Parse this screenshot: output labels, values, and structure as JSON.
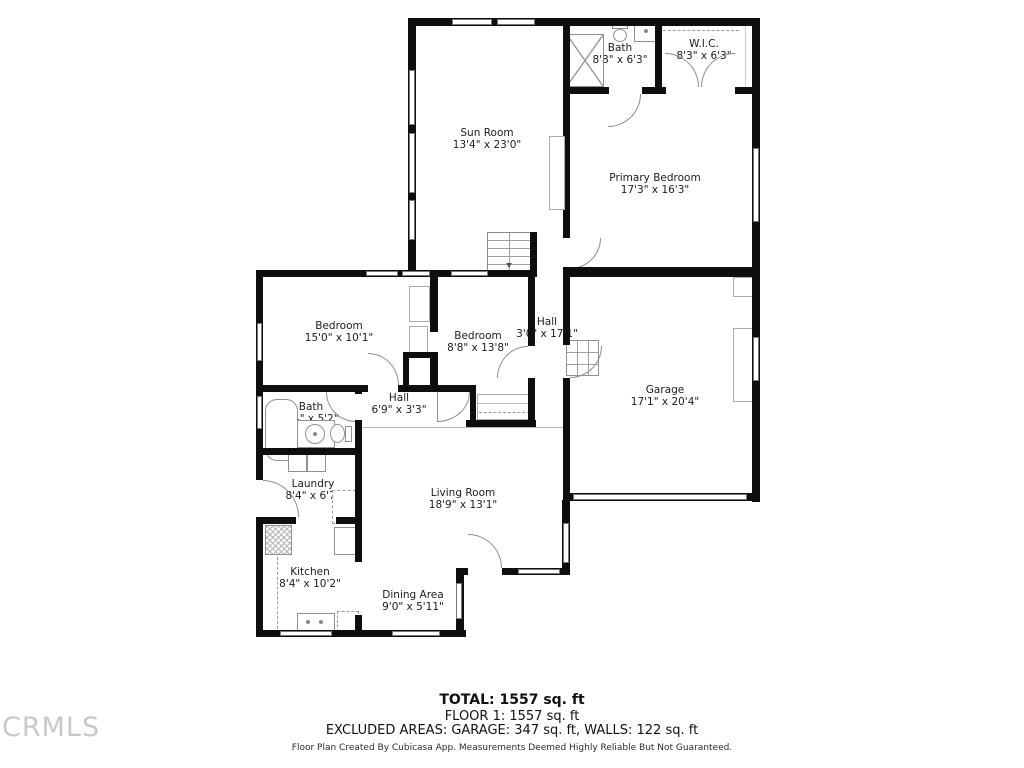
{
  "rooms": [
    {
      "id": "sun-room",
      "name": "Sun Room",
      "dims": "13'4\" x 23'0\""
    },
    {
      "id": "bath-upper",
      "name": "Bath",
      "dims": "8'8\" x 6'3\""
    },
    {
      "id": "wic",
      "name": "W.I.C.",
      "dims": "8'3\" x 6'3\""
    },
    {
      "id": "primary-bedroom",
      "name": "Primary Bedroom",
      "dims": "17'3\" x 16'3\""
    },
    {
      "id": "bedroom-left",
      "name": "Bedroom",
      "dims": "15'0\" x 10'1\""
    },
    {
      "id": "bedroom-middle",
      "name": "Bedroom",
      "dims": "8'8\" x 13'8\""
    },
    {
      "id": "hall-vertical",
      "name": "Hall",
      "dims": "3'0\" x 17'1\""
    },
    {
      "id": "garage",
      "name": "Garage",
      "dims": "17'1\" x 20'4\""
    },
    {
      "id": "bath-lower",
      "name": "Bath",
      "dims": "8'4\" x 5'2\""
    },
    {
      "id": "hall-small",
      "name": "Hall",
      "dims": "6'9\" x 3'3\""
    },
    {
      "id": "laundry",
      "name": "Laundry",
      "dims": "8'4\" x 6'7\""
    },
    {
      "id": "kitchen",
      "name": "Kitchen",
      "dims": "8'4\" x 10'2\""
    },
    {
      "id": "living-room",
      "name": "Living Room",
      "dims": "18'9\" x 13'1\""
    },
    {
      "id": "dining-area",
      "name": "Dining Area",
      "dims": "9'0\" x 5'11\""
    }
  ],
  "footer": {
    "total": "TOTAL: 1557 sq. ft",
    "floor": "FLOOR 1: 1557 sq. ft",
    "excluded": "EXCLUDED AREAS: GARAGE: 347 sq. ft, WALLS: 122 sq. ft",
    "disclaimer": "Floor Plan Created By Cubicasa App. Measurements Deemed Highly Reliable But Not Guaranteed."
  },
  "watermark": "CRMLS",
  "colors": {
    "wall": "#0e0e0e",
    "fixture_stroke": "#909090",
    "text": "#1c1c1c",
    "watermark": "#c8c8c8"
  }
}
